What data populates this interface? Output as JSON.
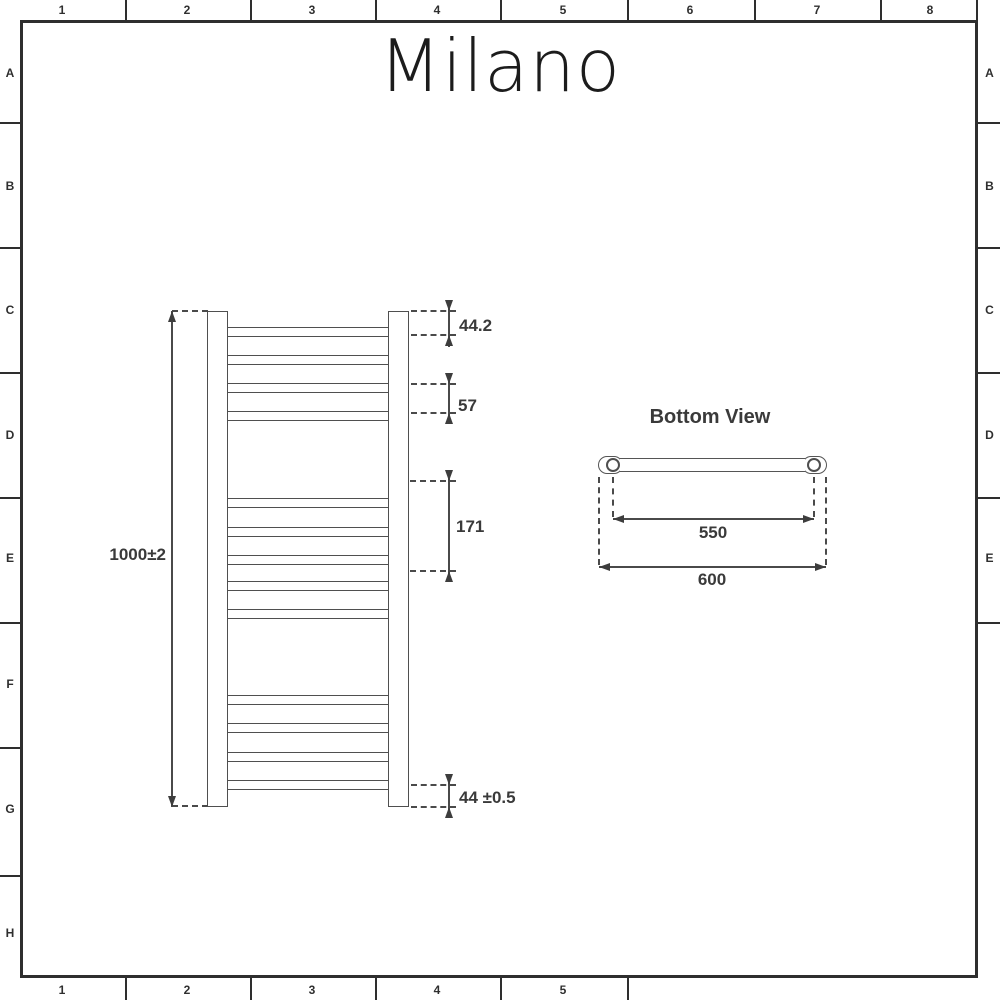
{
  "logo": {
    "text": "Milano"
  },
  "rulers": {
    "top": [
      "1",
      "2",
      "3",
      "4",
      "5",
      "6",
      "7",
      "8"
    ],
    "bottom": [
      "1",
      "2",
      "3",
      "4",
      "5"
    ],
    "left": [
      "A",
      "B",
      "C",
      "D",
      "E",
      "F",
      "G",
      "H"
    ],
    "right": [
      "A",
      "B",
      "C",
      "D",
      "E"
    ]
  },
  "front_view": {
    "overall_height": "1000±2",
    "top_rail_offset": "44.2",
    "rail_pitch": "57",
    "rail_gap": "171",
    "bottom_rail_offset": "44 ±0.5"
  },
  "bottom_view": {
    "title": "Bottom View",
    "pipe_centres": "550",
    "overall_width": "600"
  }
}
